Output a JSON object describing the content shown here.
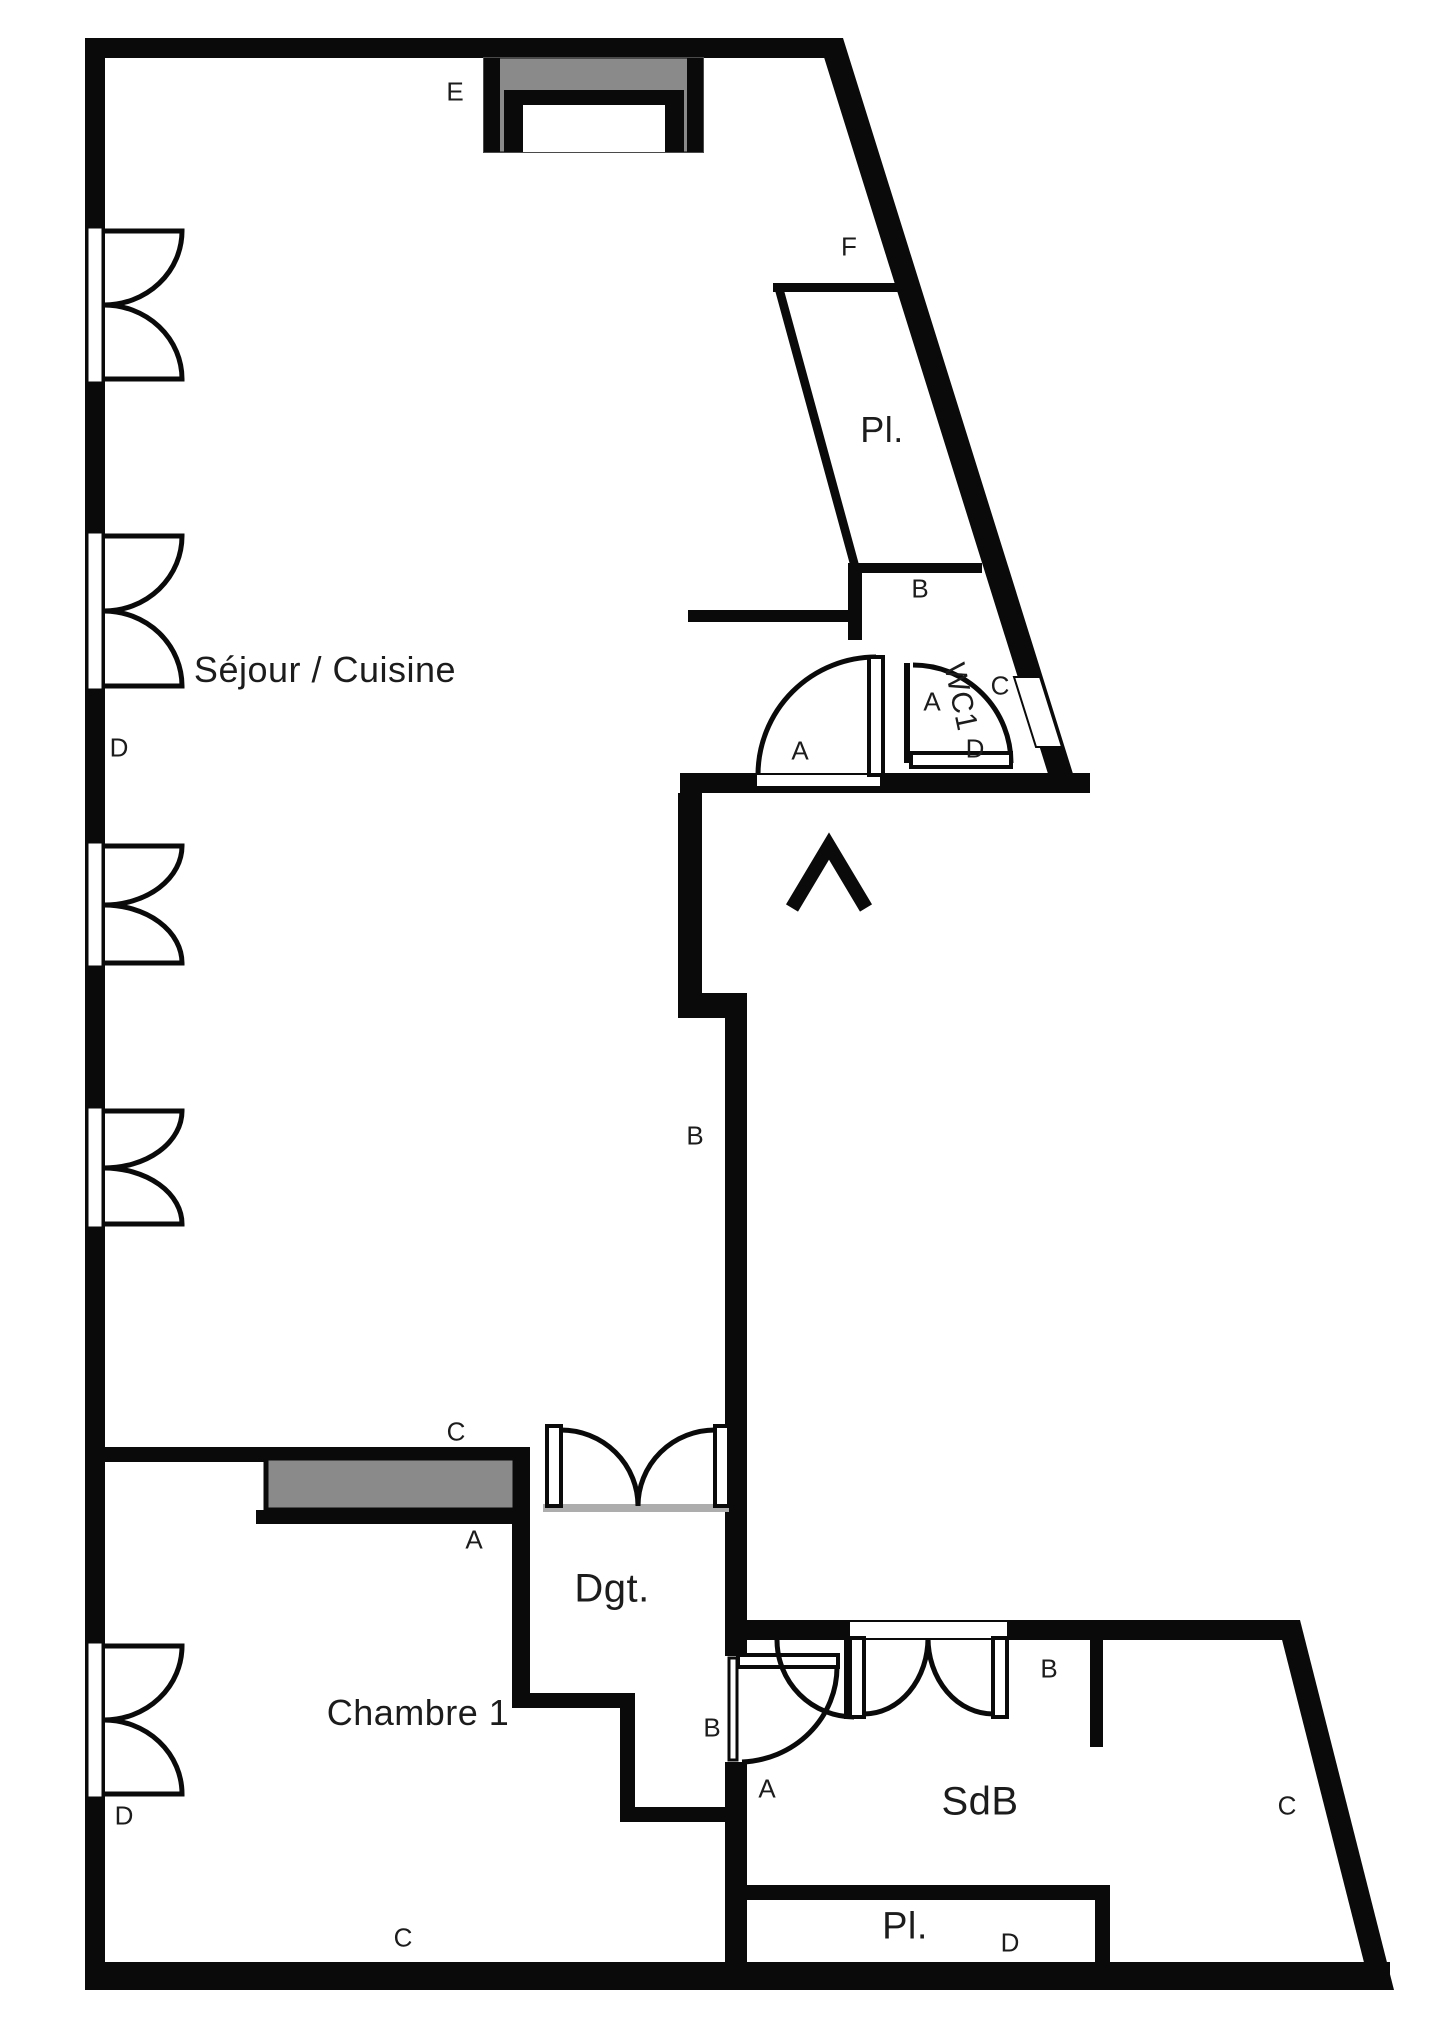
{
  "plan_title": "Apartment floor plan",
  "colors": {
    "wall": "#0a0a0a",
    "furniture_gray": "#8a8a8a",
    "background": "#ffffff",
    "sill_gray": "#adadad"
  },
  "marker_font_size": 26,
  "rooms": [
    {
      "id": "sejour-cuisine",
      "label": "Séjour / Cuisine",
      "x": 325,
      "y": 670,
      "size": 36,
      "rotate": 0
    },
    {
      "id": "placard-haut",
      "label": "Pl.",
      "x": 882,
      "y": 430,
      "size": 36,
      "rotate": 0
    },
    {
      "id": "wc1",
      "label": "WC1",
      "x": 960,
      "y": 697,
      "size": 30,
      "rotate": 78
    },
    {
      "id": "degagement",
      "label": "Dgt.",
      "x": 612,
      "y": 1589,
      "size": 40,
      "rotate": 0
    },
    {
      "id": "chambre-1",
      "label": "Chambre 1",
      "x": 418,
      "y": 1713,
      "size": 36,
      "rotate": 0
    },
    {
      "id": "salle-de-bain",
      "label": "SdB",
      "x": 980,
      "y": 1802,
      "size": 40,
      "rotate": 0
    },
    {
      "id": "placard-bas",
      "label": "Pl.",
      "x": 905,
      "y": 1927,
      "size": 38,
      "rotate": 0
    }
  ],
  "markers": [
    {
      "label": "E",
      "x": 455,
      "y": 92
    },
    {
      "label": "F",
      "x": 849,
      "y": 247
    },
    {
      "label": "B",
      "x": 920,
      "y": 589
    },
    {
      "label": "A",
      "x": 800,
      "y": 751
    },
    {
      "label": "A",
      "x": 932,
      "y": 702
    },
    {
      "label": "C",
      "x": 1000,
      "y": 686
    },
    {
      "label": "D",
      "x": 975,
      "y": 749
    },
    {
      "label": "D",
      "x": 119,
      "y": 748
    },
    {
      "label": "B",
      "x": 695,
      "y": 1136
    },
    {
      "label": "C",
      "x": 456,
      "y": 1432
    },
    {
      "label": "A",
      "x": 474,
      "y": 1540
    },
    {
      "label": "D",
      "x": 124,
      "y": 1816
    },
    {
      "label": "B",
      "x": 712,
      "y": 1728
    },
    {
      "label": "A",
      "x": 767,
      "y": 1789
    },
    {
      "label": "B",
      "x": 1049,
      "y": 1669
    },
    {
      "label": "C",
      "x": 1287,
      "y": 1806
    },
    {
      "label": "C",
      "x": 403,
      "y": 1938
    },
    {
      "label": "D",
      "x": 1010,
      "y": 1943
    }
  ],
  "symbol_legend": {
    "window-icon": "double casement window (butterfly arcs)",
    "double-door-icon": "double french door",
    "door-swing-icon": "single swing door",
    "entrance-arrow-icon": "entrance direction chevron",
    "niche-icon": "gray niche with console",
    "storage-icon": "gray storage / closet block"
  }
}
